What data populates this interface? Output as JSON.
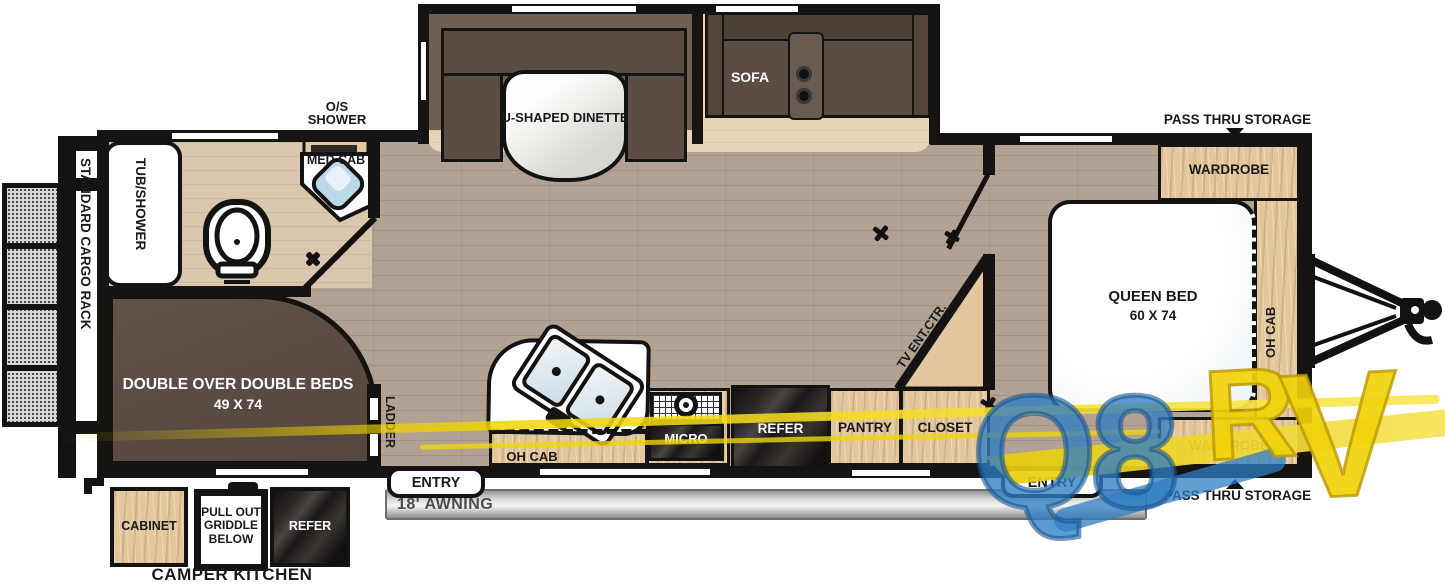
{
  "exterior": {
    "cargo_rack": "STANDARD CARGO RACK",
    "pass_thru": "PASS THRU STORAGE",
    "awning": "18' AWNING",
    "camper_kitchen": {
      "title": "CAMPER KITCHEN",
      "cabinet": "CABINET",
      "griddle": "PULL OUT GRIDDLE BELOW",
      "refer": "REFER"
    }
  },
  "bathroom": {
    "os_shower_line1": "O/S",
    "os_shower_line2": "SHOWER",
    "med_cab": "MED CAB",
    "tub": "TUB/SHOWER"
  },
  "living": {
    "dinette": "U-SHAPED DINETTE",
    "sofa": "SOFA",
    "tv": "TV ENT.CTR."
  },
  "kitchen": {
    "oh_cab": "OH CAB",
    "micro": "MICRO",
    "refer": "REFER",
    "pantry": "PANTRY",
    "closet": "CLOSET"
  },
  "bunk": {
    "label": "DOUBLE OVER DOUBLE BEDS",
    "size": "49 X 74",
    "ladder": "LADDER"
  },
  "bedroom": {
    "bed": "QUEEN BED",
    "size": "60 X 74",
    "wardrobe": "WARDROBE",
    "oh_cab": "OH CAB"
  },
  "doors": {
    "entry": "ENTRY"
  },
  "watermark": {
    "q8": "Q8",
    "rv": "RV"
  },
  "colors": {
    "wall": "#161412",
    "floor_living": "#b2a294",
    "floor_bath": "#d9c7ae",
    "floor_slide": "#e7d4b7",
    "wood": "#e2c79e",
    "bench_brown": "#5b4d44",
    "bunk_brown": "#5d4f46",
    "appliance_dark": "#1c1a19",
    "watermark_blue": "#2f7ec4",
    "watermark_yellow": "#f0d40a"
  }
}
